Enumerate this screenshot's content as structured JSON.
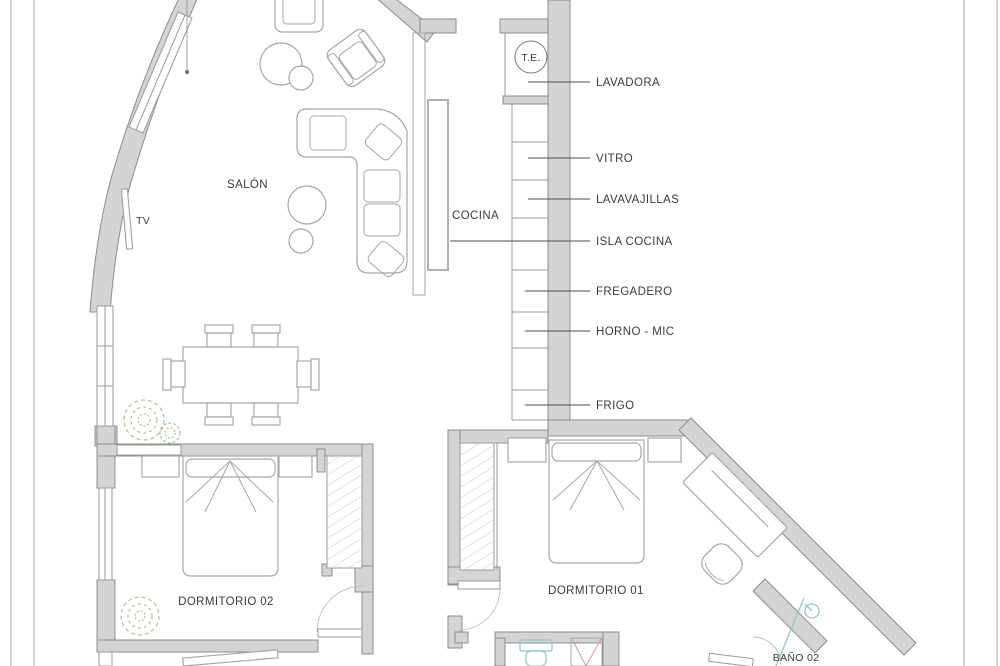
{
  "meta": {
    "drawing_type": "apartment floor plan"
  },
  "colors": {
    "wall_fill": "#d4d4d4",
    "wall_stroke": "#8c8c8c",
    "furniture_stroke": "#a6a6a6",
    "leader_line": "#4d4d4d",
    "label_text": "#3a3a3a",
    "plant_green": "#9dc183",
    "fixture_teal": "#92c7c7",
    "fixture_red": "#cf9d9d",
    "page_border": "#b3b3b3"
  },
  "rooms": {
    "salon": {
      "label": "SALÓN"
    },
    "cocina": {
      "label": "COCINA"
    },
    "dormitorio_02": {
      "label": "DORMITORIO 02"
    },
    "dormitorio_01": {
      "label": "DORMITORIO 01"
    },
    "bano_02": {
      "label": "BAÑO 02"
    }
  },
  "annotations": {
    "tv": "TV",
    "telecom_box": "T.E."
  },
  "kitchen_callouts": [
    {
      "label": "LAVADORA"
    },
    {
      "label": "VITRO"
    },
    {
      "label": "LAVAVAJILLAS"
    },
    {
      "label": "ISLA COCINA"
    },
    {
      "label": "FREGADERO"
    },
    {
      "label": "HORNO - MIC"
    },
    {
      "label": "FRIGO"
    }
  ]
}
